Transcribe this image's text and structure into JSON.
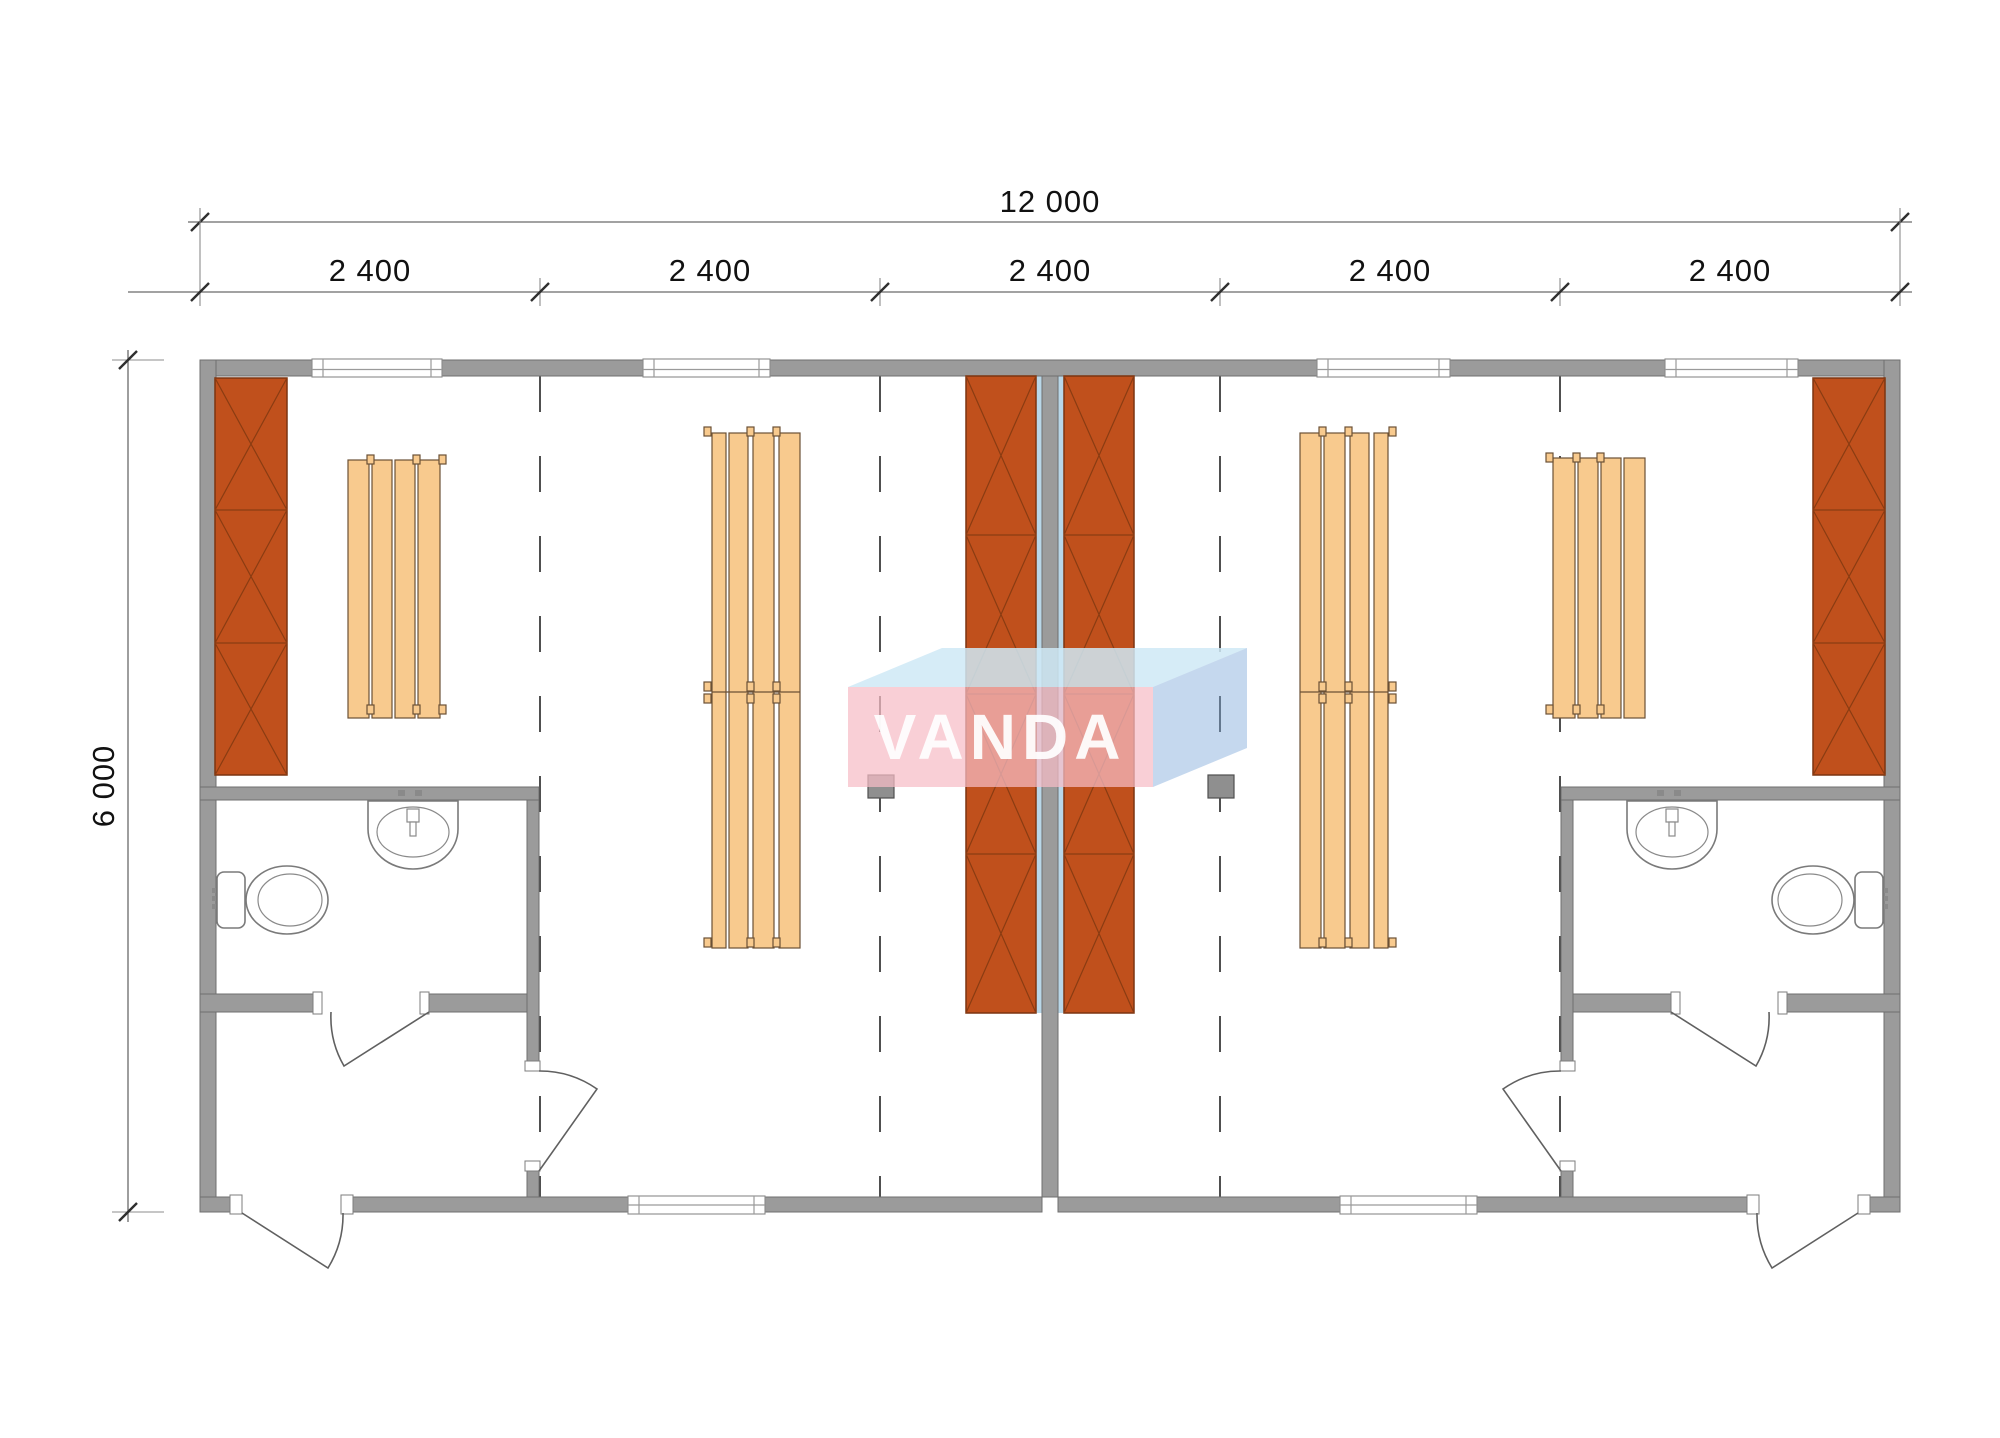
{
  "drawing": {
    "overall_width_label": "12 000",
    "overall_height_label": "6 000",
    "module_labels": [
      "2 400",
      "2 400",
      "2 400",
      "2 400",
      "2 400"
    ]
  },
  "logo": {
    "text": "VANDA"
  },
  "colors": {
    "wall": "#9b9b9b",
    "cabinet": "#c0501c",
    "bench": "#f8ca8e",
    "liner": "#b9d7e8",
    "heater": "#8f8f8f",
    "logo_front": "#f6bcc6",
    "logo_top": "#cfe9f6",
    "logo_side": "#7fa9d9"
  }
}
